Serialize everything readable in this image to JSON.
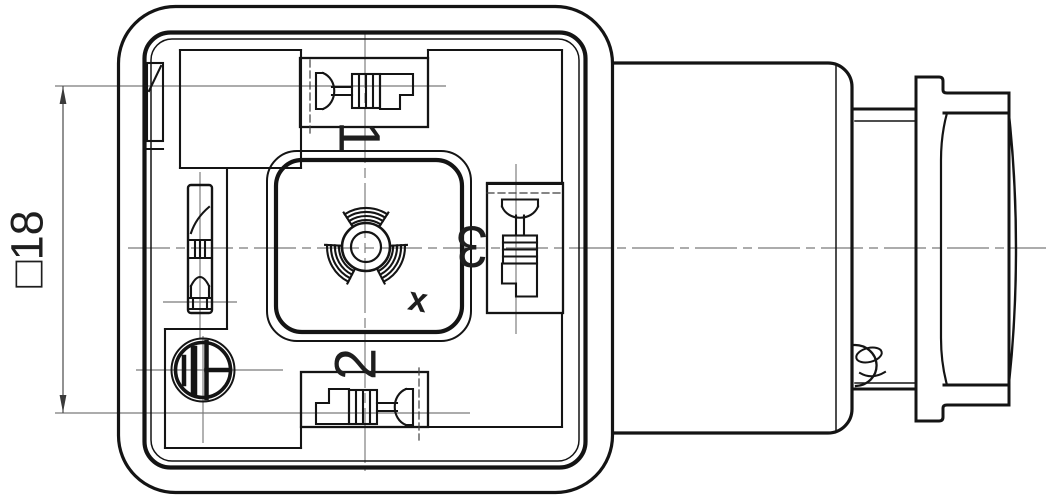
{
  "page": {
    "background": "#ffffff"
  },
  "colors": {
    "line": "#141414",
    "centerline": "#7a7a7a",
    "dimension": "#4a4a4a",
    "hidden": "#3f3f3f",
    "text": "#1e1e1e"
  },
  "drawing": {
    "kind": "valve-connector-technical-drawing",
    "dimension": {
      "label": "□18"
    },
    "terminals": {
      "t1": "1",
      "t2": "2",
      "t3": "3"
    },
    "center_marking": "x"
  }
}
